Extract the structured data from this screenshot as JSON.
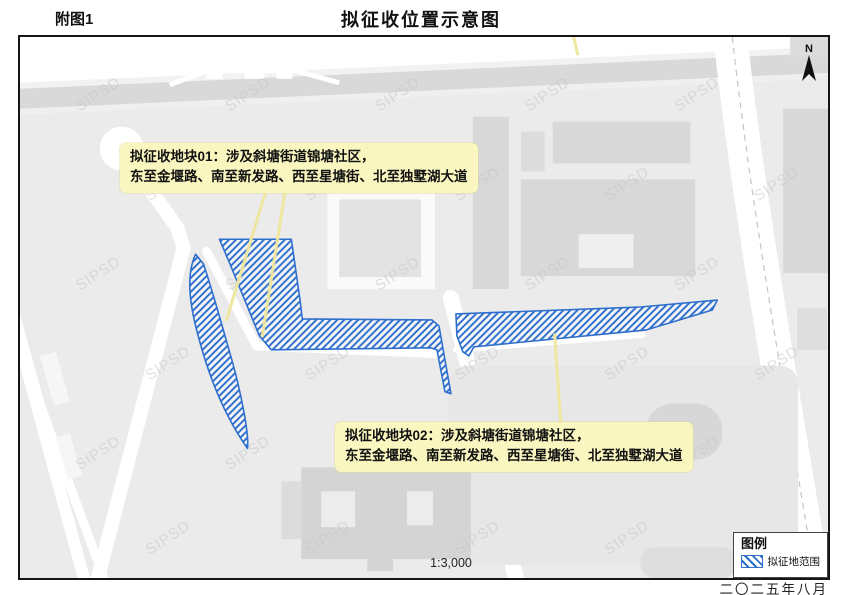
{
  "page": {
    "figure_label": "附图1",
    "title": "拟征收位置示意图"
  },
  "map": {
    "watermark": "SIPSD",
    "scale_text": "1:3,000",
    "north_label": "N",
    "callouts": [
      {
        "id": "01",
        "line1": "拟征收地块01：涉及斜塘街道锦塘社区，",
        "line2": "东至金堰路、南至新发路、西至星塘街、北至独墅湖大道"
      },
      {
        "id": "02",
        "line1": "拟征收地块02：涉及斜塘街道锦塘社区，",
        "line2": "东至金堰路、南至新发路、西至星塘街、北至独墅湖大道"
      }
    ]
  },
  "legend": {
    "title": "图例",
    "items": [
      {
        "label": "拟征地范围",
        "swatch": "blue-diagonal-hatch"
      }
    ]
  },
  "footer": {
    "date": "二〇二五年八月"
  },
  "colors": {
    "hatch_blue": "#2e6fce",
    "callout_yellow": "#faf6c0",
    "leader_yellow": "#efe79e",
    "map_background": "#ebebeb",
    "road_white": "#ffffff",
    "building_gray": "#d8d8d8",
    "road_band_gray": "#d9d9d9",
    "watermark_gray": "#c7c7c7",
    "frame_black": "#151515"
  }
}
